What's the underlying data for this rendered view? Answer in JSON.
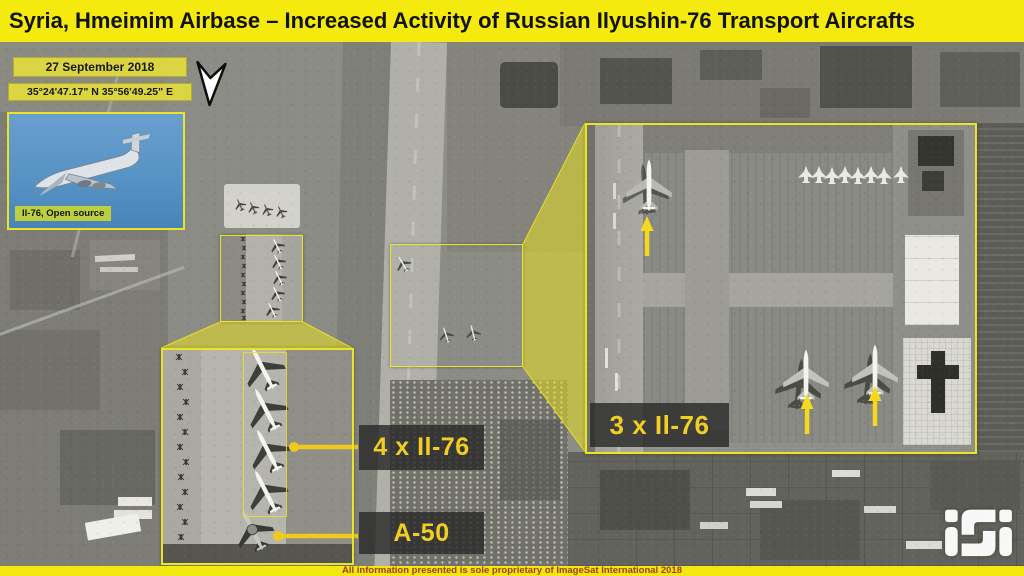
{
  "header": {
    "title": "Syria, Hmeimim Airbase – Increased Activity of Russian Ilyushin-76 Transport Aircrafts"
  },
  "info_boxes": {
    "date": "27 September 2018",
    "coordinates": "35°24'47.17\" N  35°56'49.25\" E"
  },
  "photo_inset": {
    "caption": "Il-76, Open source"
  },
  "annotations": {
    "left_zoom_label": "4 x Il-76",
    "a50_label": "A-50",
    "right_zoom_label": "3 x Il-76"
  },
  "footer": {
    "disclaimer": "All information presented is sole proprietary of ImageSat International 2018"
  },
  "logo": {
    "text": "iSi"
  },
  "colors": {
    "accent_yellow": "#f2e70e",
    "label_text_yellow": "#f1ce25",
    "arrow_yellow": "#f6d91f",
    "footer_text": "#a33b12"
  }
}
